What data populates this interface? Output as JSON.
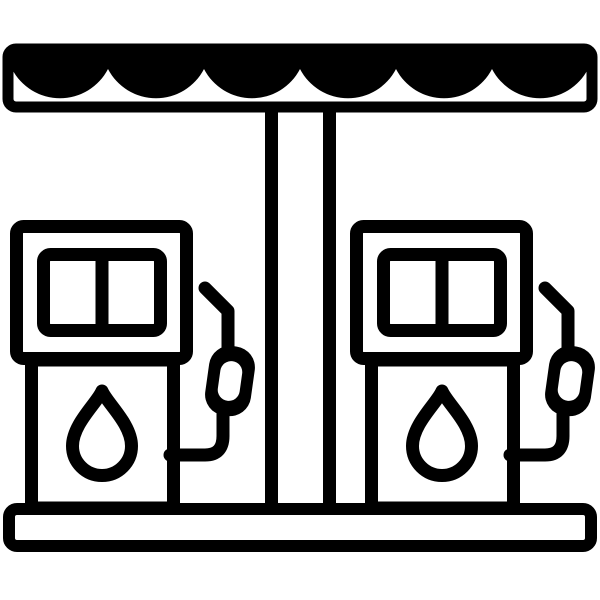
{
  "icon": {
    "name": "gas-station",
    "description": "Black and white outline icon of a gas station: scalloped canopy on a central pillar over two fuel pumps, each with a two-pane display screen, a fuel drop symbol, and a hose with nozzle, standing on a base platform",
    "colors": {
      "foreground": "#000000",
      "background": "#ffffff"
    },
    "counts": {
      "pumps": 2,
      "awning_scallops": 6,
      "screen_panes_per_pump": 2
    }
  }
}
